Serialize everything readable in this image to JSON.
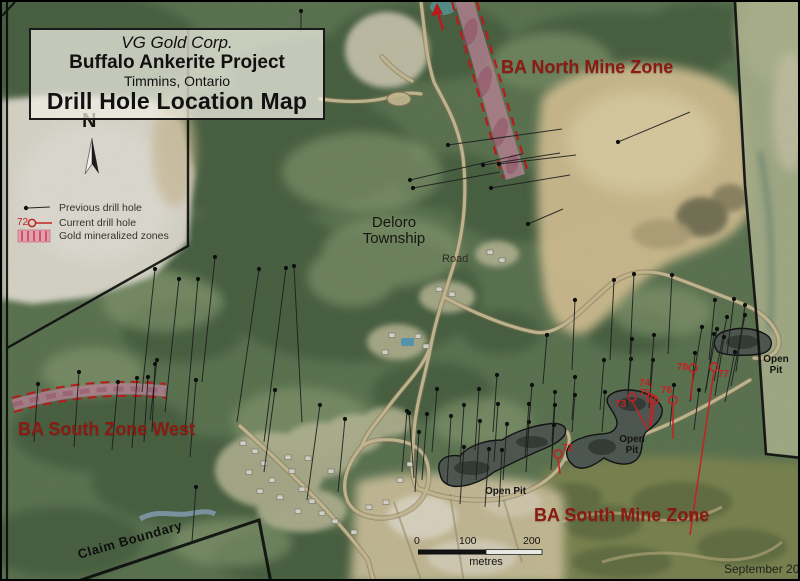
{
  "map": {
    "title_block": {
      "company": "VG Gold Corp.",
      "project": "Buffalo Ankerite Project",
      "location": "Timmins, Ontario",
      "map_title": "Drill Hole Location Map"
    },
    "north_label": "N",
    "legend": {
      "items": [
        {
          "label": "Previous drill hole"
        },
        {
          "prefix": "72",
          "label": "Current drill hole"
        },
        {
          "label": "Gold mineralized zones"
        }
      ]
    },
    "labels": {
      "north_zone": "BA North Mine Zone",
      "township_line1": "Deloro",
      "township_line2": "Township",
      "road": "Road",
      "south_zone_west": "BA South Zone West",
      "south_zone": "BA South Mine Zone",
      "open_pit": "Open Pit",
      "open_pit_word1": "Open",
      "open_pit_word2": "Pit",
      "claim_boundary": "Claim Boundary",
      "date": "September 2007"
    },
    "scale_bar": {
      "ticks": [
        "0",
        "100",
        "200"
      ],
      "unit": "metres"
    },
    "colors": {
      "zone_label": "#8b1a12",
      "current_hole": "#c32222",
      "mineralized_fill": "#cb8fa4",
      "mineralized_dash": "#cc2020",
      "boundary": "#0d0d0d",
      "pit_water": "#566059",
      "road": "#d8cba2",
      "sand": "#e0cc9c"
    },
    "current_drill_holes": [
      {
        "label": "72",
        "cx": 556,
        "cy": 452,
        "tx": 560,
        "ty": 440,
        "ex": 558,
        "ey": 472
      },
      {
        "label": "73",
        "cx": 630,
        "cy": 395,
        "tx": 613,
        "ty": 396,
        "ex": 646,
        "ey": 428
      },
      {
        "label": "74,",
        "cx": 649,
        "cy": 396,
        "tx": 637,
        "ty": 375,
        "ex": 648,
        "ey": 424
      },
      {
        "label": "75",
        "cx": 652,
        "cy": 398,
        "tx": 637,
        "ty": 385,
        "ex": 649,
        "ey": 424
      },
      {
        "label": "76",
        "cx": 671,
        "cy": 398,
        "tx": 659,
        "ty": 382,
        "ex": 671,
        "ey": 437
      },
      {
        "label": "77",
        "cx": 712,
        "cy": 365,
        "tx": 716,
        "ty": 366,
        "ex": 688,
        "ey": 533
      },
      {
        "label": "78",
        "cx": 691,
        "cy": 366,
        "tx": 675,
        "ty": 359,
        "ex": 689,
        "ey": 398
      }
    ],
    "previous_drill_holes": [
      [
        408,
        178,
        520,
        152
      ],
      [
        411,
        186,
        498,
        170
      ],
      [
        446,
        143,
        560,
        127
      ],
      [
        481,
        163,
        558,
        151
      ],
      [
        497,
        162,
        574,
        153
      ],
      [
        489,
        186,
        568,
        173
      ],
      [
        616,
        140,
        688,
        110
      ],
      [
        526,
        222,
        561,
        207
      ],
      [
        299,
        9,
        299,
        30
      ],
      [
        153,
        267,
        140,
        390
      ],
      [
        177,
        277,
        163,
        410
      ],
      [
        196,
        277,
        183,
        430
      ],
      [
        213,
        255,
        200,
        380
      ],
      [
        257,
        267,
        235,
        420
      ],
      [
        284,
        266,
        262,
        440
      ],
      [
        292,
        264,
        300,
        420
      ],
      [
        36,
        382,
        32,
        440
      ],
      [
        77,
        370,
        72,
        445
      ],
      [
        116,
        380,
        110,
        448
      ],
      [
        135,
        376,
        130,
        446
      ],
      [
        146,
        375,
        142,
        440
      ],
      [
        153,
        362,
        150,
        430
      ],
      [
        194,
        378,
        188,
        455
      ],
      [
        155,
        358,
        148,
        418
      ],
      [
        194,
        485,
        190,
        540
      ],
      [
        273,
        388,
        262,
        470
      ],
      [
        318,
        403,
        305,
        498
      ],
      [
        343,
        417,
        336,
        490
      ],
      [
        405,
        409,
        400,
        470
      ],
      [
        407,
        411,
        412,
        476
      ],
      [
        425,
        412,
        420,
        478
      ],
      [
        435,
        387,
        430,
        450
      ],
      [
        449,
        414,
        445,
        482
      ],
      [
        462,
        403,
        458,
        462
      ],
      [
        462,
        445,
        458,
        502
      ],
      [
        477,
        387,
        473,
        448
      ],
      [
        478,
        419,
        474,
        478
      ],
      [
        487,
        447,
        483,
        505
      ],
      [
        495,
        373,
        491,
        430
      ],
      [
        496,
        402,
        492,
        460
      ],
      [
        505,
        422,
        501,
        478
      ],
      [
        500,
        448,
        497,
        505
      ],
      [
        527,
        402,
        523,
        455
      ],
      [
        527,
        420,
        524,
        470
      ],
      [
        530,
        383,
        526,
        435
      ],
      [
        545,
        333,
        541,
        382
      ],
      [
        553,
        390,
        550,
        440
      ],
      [
        553,
        403,
        550,
        450
      ],
      [
        552,
        423,
        549,
        468
      ],
      [
        417,
        430,
        413,
        490
      ],
      [
        573,
        298,
        570,
        368
      ],
      [
        612,
        278,
        608,
        358
      ],
      [
        632,
        272,
        628,
        352
      ],
      [
        670,
        273,
        666,
        352
      ],
      [
        713,
        298,
        707,
        358
      ],
      [
        732,
        297,
        725,
        352
      ],
      [
        573,
        375,
        570,
        418
      ],
      [
        573,
        393,
        570,
        430
      ],
      [
        602,
        358,
        598,
        408
      ],
      [
        603,
        390,
        600,
        430
      ],
      [
        629,
        357,
        625,
        405
      ],
      [
        630,
        337,
        626,
        388
      ],
      [
        651,
        358,
        647,
        406
      ],
      [
        652,
        333,
        648,
        384
      ],
      [
        672,
        383,
        668,
        424
      ],
      [
        693,
        351,
        688,
        400
      ],
      [
        697,
        388,
        692,
        428
      ],
      [
        712,
        332,
        704,
        388
      ],
      [
        722,
        335,
        713,
        394
      ],
      [
        733,
        350,
        723,
        400
      ],
      [
        743,
        303,
        734,
        370
      ],
      [
        725,
        315,
        712,
        379
      ],
      [
        700,
        325,
        690,
        384
      ],
      [
        715,
        327,
        703,
        391
      ],
      [
        743,
        313,
        729,
        384
      ]
    ],
    "buildings": [
      [
        253,
        449
      ],
      [
        262,
        461
      ],
      [
        247,
        470
      ],
      [
        270,
        478
      ],
      [
        258,
        489
      ],
      [
        278,
        495
      ],
      [
        290,
        469
      ],
      [
        286,
        455
      ],
      [
        300,
        487
      ],
      [
        310,
        499
      ],
      [
        296,
        509
      ],
      [
        320,
        511
      ],
      [
        241,
        441
      ],
      [
        333,
        519
      ],
      [
        352,
        530
      ],
      [
        306,
        456
      ],
      [
        329,
        469
      ],
      [
        390,
        333
      ],
      [
        416,
        334
      ],
      [
        424,
        344
      ],
      [
        383,
        350
      ],
      [
        437,
        287
      ],
      [
        450,
        292
      ],
      [
        488,
        250
      ],
      [
        500,
        258
      ],
      [
        367,
        505
      ],
      [
        384,
        500
      ],
      [
        398,
        478
      ],
      [
        408,
        462
      ]
    ]
  }
}
